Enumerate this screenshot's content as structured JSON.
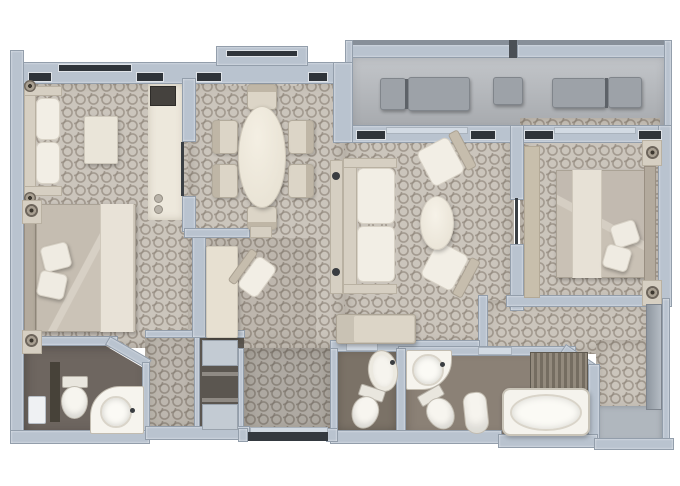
{
  "plan": {
    "title": "Two-bedroom suite floor plan (top-down 3D render)",
    "palette": {
      "wall": "#b9c3cf",
      "wall_outline": "#939eab",
      "carpet": "#cbc5bc",
      "carpet_lattice": "#948b80",
      "balcony_floor": "#b4b7bb",
      "wc_floor": "#6e6660",
      "small_bath_floor": "#7b7267",
      "main_bath_floor": "#8b8176",
      "kitchenette_floor": "#ede8dc",
      "furniture_cream": "#f2eee5",
      "furniture_greige": "#d6cfc2",
      "window_glass": "#2f343a",
      "door_leaf": "#3a3f44",
      "wardrobe": "#8f97a0"
    },
    "rooms": {
      "balcony": {
        "label": "Balcony",
        "furniture": [
          "sun-lounger",
          "side-table",
          "sun-lounger"
        ]
      },
      "bedroom1": {
        "label": "Bedroom 1 with sitting area",
        "furniture": [
          "two-seat-sofa",
          "coffee-table",
          "double-bed",
          "nightstand-with-lamp",
          "nightstand-with-lamp",
          "pillows"
        ]
      },
      "kitchenette": {
        "label": "Wet bar / pantry",
        "furniture": [
          "counter-appliance",
          "minibar"
        ]
      },
      "dining": {
        "label": "Dining room",
        "furniture": [
          "oval-dining-table",
          "dining-chair",
          "dining-chair",
          "dining-chair",
          "dining-chair",
          "dining-chair",
          "dining-chair"
        ],
        "chair_count": 6
      },
      "living": {
        "label": "Living room",
        "furniture": [
          "sofa",
          "console-table",
          "armchair",
          "armchair",
          "oval-coffee-table",
          "bench"
        ]
      },
      "hallway": {
        "label": "Hallway with desk",
        "furniture": [
          "desk",
          "desk-chair",
          "wall-shelf"
        ]
      },
      "bedroom2": {
        "label": "Bedroom 2",
        "furniture": [
          "double-bed",
          "nightstand-with-lamp",
          "nightstand-with-lamp",
          "dresser",
          "pillows"
        ]
      },
      "wc": {
        "label": "Guest WC",
        "furniture": [
          "toilet",
          "corner-washbasin",
          "privacy-partition",
          "wall-cabinet"
        ]
      },
      "closet": {
        "label": "Closet with shelves",
        "furniture": [
          "shelf",
          "hanging-rail",
          "hanging-rail",
          "shelf"
        ]
      },
      "entry": {
        "label": "Entry hall",
        "furniture": [
          "entry-door"
        ]
      },
      "small_bathroom": {
        "label": "Shower bathroom",
        "furniture": [
          "washbasin",
          "toilet"
        ]
      },
      "main_bathroom": {
        "label": "Main bathroom",
        "furniture": [
          "round-washbasin",
          "toilet",
          "bidet",
          "bathtub",
          "shower-screen"
        ]
      },
      "dressing": {
        "label": "Dressing area",
        "furniture": [
          "wardrobe"
        ]
      }
    }
  }
}
